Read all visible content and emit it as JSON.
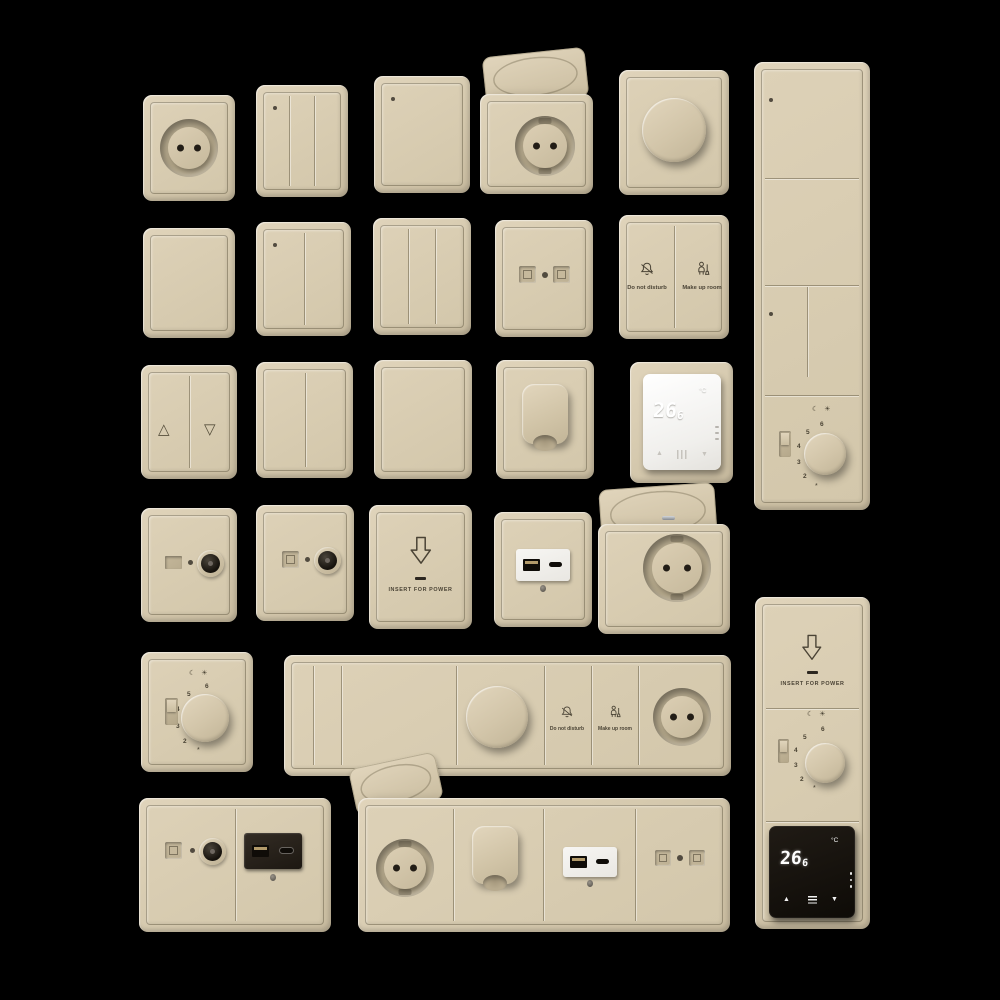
{
  "background": "#000000",
  "palette": {
    "beige": "#d6caaf",
    "beige_light": "#e0d4bb",
    "beige_dark": "#c8bb9f",
    "groove_brown": "#60573f",
    "print_dark": "#4a4335",
    "device_white": "#f4f3f0",
    "device_black": "#17130e"
  },
  "labels": {
    "do_not_disturb": "Do not disturb",
    "make_up_room": "Make up room",
    "insert_for_power": "INSERT FOR POWER"
  },
  "thermostat": {
    "value_int": "26",
    "value_frac": "6",
    "unit": "°C"
  },
  "dial": {
    "numbers": [
      "6",
      "5",
      "4",
      "3",
      "2"
    ],
    "frost_mark": "*"
  },
  "icons": {
    "triangle_up": "△",
    "triangle_down": "▽",
    "arrow_up": "▲",
    "arrow_down": "▼",
    "crescent_moon": "☾",
    "sun": "☀"
  }
}
